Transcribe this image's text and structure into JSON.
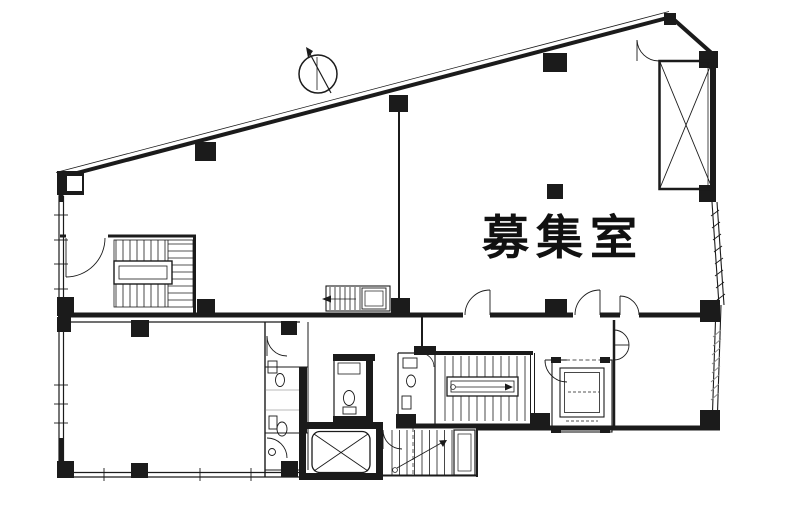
{
  "canvas": {
    "width": 787,
    "height": 507,
    "background": "#ffffff",
    "ink": "#1b1b1b",
    "hatch": "#8a8a8a"
  },
  "floorplan": {
    "room_label": "募集室",
    "icons": {
      "north_arrow": "north-arrow-icon",
      "upper_shaft": "x-braced-shaft",
      "central_elevator": "x-car-elevator",
      "east_elevator": "elevator-car",
      "stairs": [
        "northwest-staircase",
        "small-staircase",
        "central-staircase",
        "lower-staircase"
      ],
      "sanitary": [
        "west-toilet-strip",
        "center-wc",
        "mid-wc"
      ],
      "doors": "quarter-arc-door-swings",
      "windows": "hatched-window-walls",
      "columns": "filled-square-columns"
    }
  }
}
